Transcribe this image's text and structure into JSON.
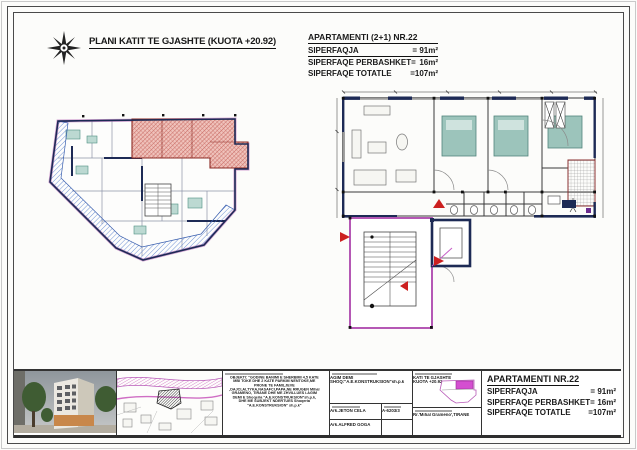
{
  "sheet": {
    "title": "PLANI KATIT TE GJASHTE (KUOTA +20.92)"
  },
  "apartment_summary": {
    "title": "APARTAMENTI (2+1) NR.22",
    "rows": [
      {
        "label": "SIPERFAQJA",
        "value": "=  91m²"
      },
      {
        "label": "SIPERFAQE PERBASHKET=",
        "value": "16m²"
      },
      {
        "label": "SIPERFAQE TOTATLE",
        "value": "=107m²"
      }
    ]
  },
  "title_block": {
    "object_lines": [
      "OBJEKTI: \"GODINE  BANIMI E SHERBIMI 4,5 KATE",
      "MBI TOKE DHE 2 KATE PARKIM NENTOKE,ME",
      "PRONE TE FAMILJEVE",
      ",DAJCI,ALTYKA,NASAFCI,PAPA,NE RRUGEN Mihal",
      "GRAMENO, TIRANE DHE ME ZHVILLUES i.AGIM",
      "DEMI E Shoqeria \"A.E.KONSTRUKSION\"sh.p.k,",
      "DHE ME SUBJEKT NDERTUES  Shoqeria",
      "\"A.E.KONSTRUKSION\" sh.p.k\""
    ],
    "investor_name": "AGIM DEMI",
    "investor_firm": "SHOQ:\"A.E.KONSTRUKSION\"sh.p.k",
    "architect_1": "Ark.JETON CELA",
    "architect_1_license": "A-6203/3",
    "architect_2": "Ark.ALFRED GOGA",
    "sheet_name": "KATI TE GJASHTE",
    "sheet_level": "KUOTA +20.92",
    "address": "Rr.'Mihal Grameno',TIRANE",
    "apartment": {
      "title": "APARTAMENTI NR.22",
      "rows": [
        {
          "label": "SIPERFAQJA",
          "value": "=  91m²"
        },
        {
          "label": "SIPERFAQE PERBASHKET=",
          "value": "16m²"
        },
        {
          "label": "SIPERFAQE TOTATLE",
          "value": "=107m²"
        }
      ]
    }
  },
  "colors": {
    "wall_navy": "#1d2a55",
    "hatch_blue": "#4d79cc",
    "hatch_red": "#b8403a",
    "highlight_magenta": "#c75fc7",
    "arrow_red": "#cc2020",
    "furniture_teal": "#9cc4bb"
  }
}
